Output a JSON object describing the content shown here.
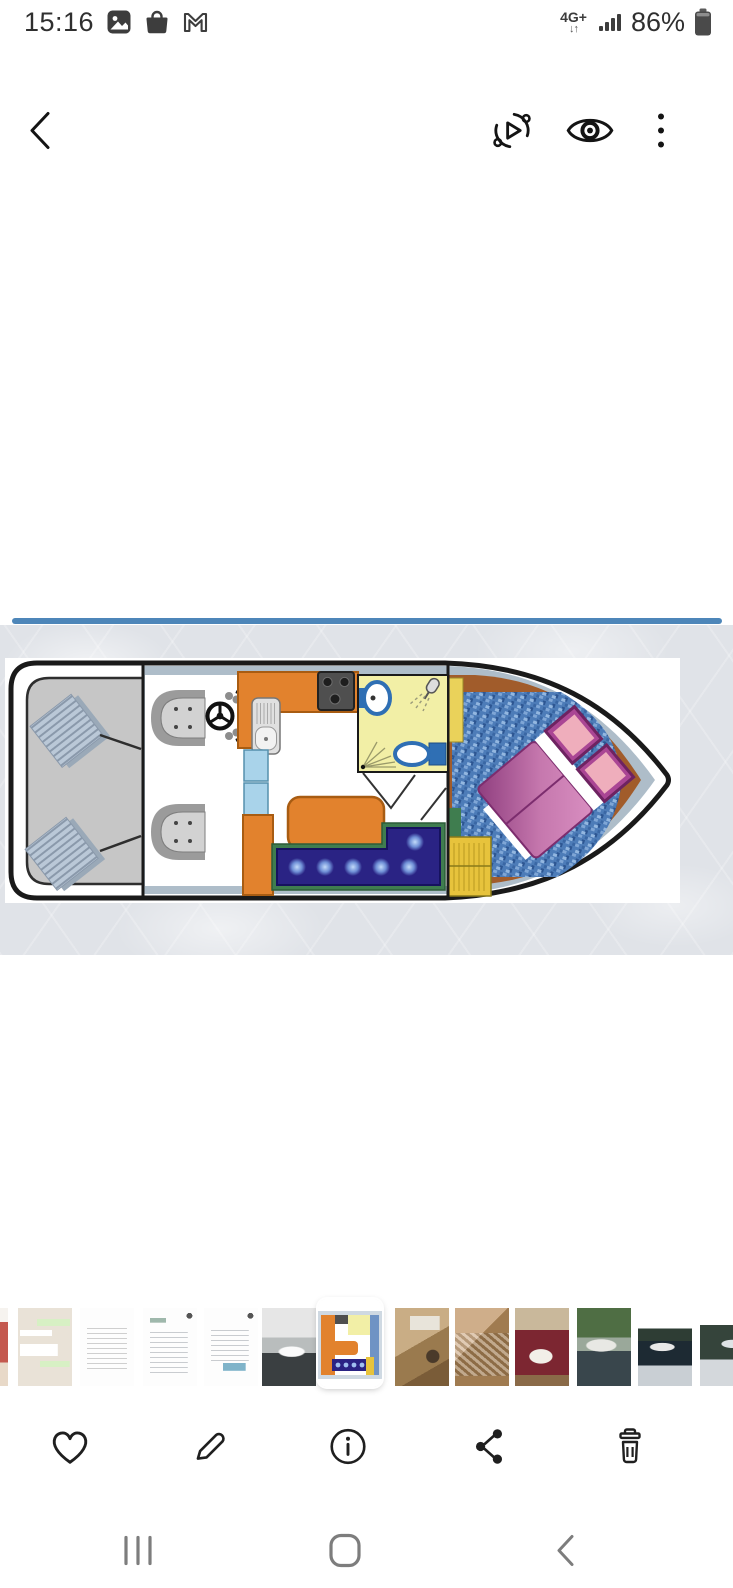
{
  "status_bar": {
    "time": "15:16",
    "network_label": "4G+",
    "battery_percent": "86%",
    "notification_icons": [
      "gallery-icon",
      "shopping-bag-icon",
      "gmail-icon"
    ]
  },
  "app_bar": {
    "buttons": [
      "back",
      "motion-photo",
      "preview-eye",
      "more-options"
    ]
  },
  "viewer": {
    "subject": "boat-interior-floor-plan-top-view",
    "accent_line_color": "#4d86b9",
    "plan_colors": {
      "hull_outline": "#1a1a1a",
      "deck_gray": "#c6c6c6",
      "walkway_rim": "#aebdc9",
      "kitchen_orange": "#e2822d",
      "bathroom_yellow": "#f2efa6",
      "fixture_blue": "#2f6fb4",
      "sofa_navy": "#2a2384",
      "sofa_trim_green": "#3f7d4f",
      "carpet_blue": "#4d7cb8",
      "bed_magenta": "#b0549c",
      "pillow_pink": "#efaebc",
      "bow_floor_brown": "#a15c2b",
      "cabinet_yellow": "#e7c33c",
      "door_blue": "#a9d3ea"
    }
  },
  "filmstrip": {
    "selected_index": 6,
    "items": [
      "photo-edge-partial",
      "chat-screenshot",
      "document-screenshot-1",
      "document-screenshot-2",
      "document-screenshot-3",
      "boat-photo-bw",
      "floor-plan-selected",
      "kitchen-photo",
      "bed-photo",
      "saloon-photo",
      "boat-dock-photo",
      "boat-water-photo",
      "boat-photo-partial"
    ]
  },
  "action_bar": {
    "buttons": [
      "favorite",
      "edit",
      "details",
      "share",
      "delete"
    ]
  },
  "nav_bar": {
    "buttons": [
      "recents",
      "home",
      "back"
    ]
  }
}
